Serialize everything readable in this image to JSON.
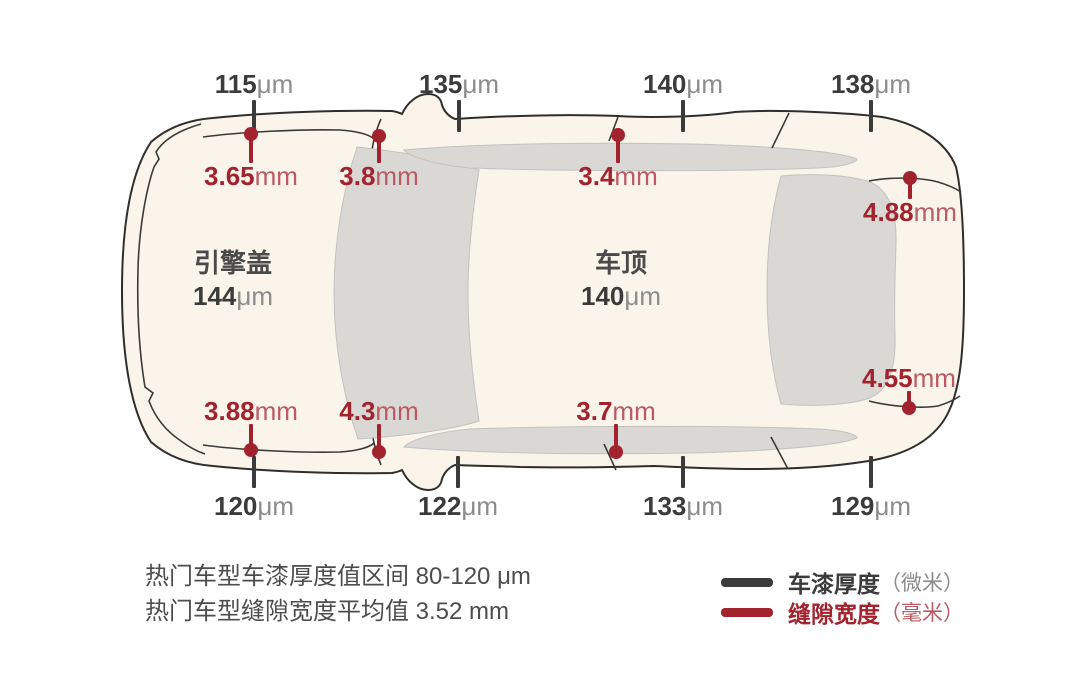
{
  "colors": {
    "background": "#ffffff",
    "body_fill": "#FAF4EA",
    "glass_fill": "#D9D8D5",
    "glass_stroke": "#C3C2BF",
    "outline": "#2F2E2C",
    "paint_color": "#3B3B3B",
    "paint_unit_color": "#8C8C8C",
    "gap_color": "#A2232E",
    "gap_unit_color": "#BC5A63"
  },
  "panel_labels": {
    "hood": {
      "name": "引擎盖",
      "value": "144",
      "unit": "μm"
    },
    "roof": {
      "name": "车顶",
      "value": "140",
      "unit": "μm"
    }
  },
  "paint_measurements": {
    "unit": "μm",
    "items": [
      {
        "value": "115",
        "x": 254,
        "side": "top"
      },
      {
        "value": "135",
        "x": 459,
        "side": "top"
      },
      {
        "value": "140",
        "x": 683,
        "side": "top"
      },
      {
        "value": "138",
        "x": 871,
        "side": "top"
      },
      {
        "value": "120",
        "x": 254,
        "side": "bottom"
      },
      {
        "value": "122",
        "x": 458,
        "side": "bottom"
      },
      {
        "value": "133",
        "x": 683,
        "side": "bottom"
      },
      {
        "value": "129",
        "x": 871,
        "side": "bottom"
      }
    ]
  },
  "gap_measurements": {
    "unit": "mm",
    "items": [
      {
        "value": "3.65",
        "x": 251,
        "dot_y": 134,
        "text_y": 176
      },
      {
        "value": "3.8",
        "x": 379,
        "dot_y": 136,
        "text_y": 176
      },
      {
        "value": "3.4",
        "x": 618,
        "dot_y": 135,
        "text_y": 176
      },
      {
        "value": "4.88",
        "x": 910,
        "dot_y": 178,
        "text_y": 212
      },
      {
        "value": "3.88",
        "x": 251,
        "dot_y": 450,
        "text_y": 411
      },
      {
        "value": "4.3",
        "x": 379,
        "dot_y": 452,
        "text_y": 411
      },
      {
        "value": "3.7",
        "x": 616,
        "dot_y": 452,
        "text_y": 411
      },
      {
        "value": "4.55",
        "x": 909,
        "dot_y": 408,
        "text_y": 378
      }
    ]
  },
  "notes": {
    "line1": "热门车型车漆厚度值区间 80-120 μm",
    "line2": "热门车型缝隙宽度平均值 3.52 mm"
  },
  "legend": {
    "paint": {
      "label": "车漆厚度",
      "unit": "（微米）"
    },
    "gap": {
      "label": "缝隙宽度",
      "unit": "（毫米）"
    }
  }
}
